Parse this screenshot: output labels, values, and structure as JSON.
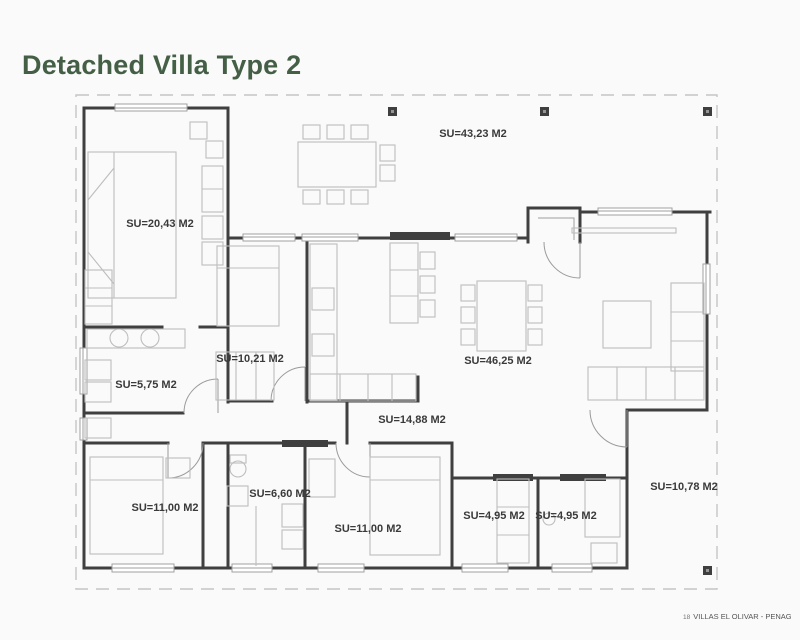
{
  "page": {
    "title": "Detached Villa Type 2"
  },
  "footer": {
    "prefix": "18",
    "text": "VILLAS EL OLIVAR - PENAGUILA"
  },
  "plan": {
    "rooms": [
      {
        "name": "front-terrace",
        "label": "SU=43,23 M2"
      },
      {
        "name": "bedroom-1",
        "label": "SU=20,43 M2"
      },
      {
        "name": "bedroom-2",
        "label": "SU=10,21 M2"
      },
      {
        "name": "bathroom-1",
        "label": "SU=5,75 M2"
      },
      {
        "name": "living-dining",
        "label": "SU=46,25 M2"
      },
      {
        "name": "kitchen-hall",
        "label": "SU=14,88 M2"
      },
      {
        "name": "bedroom-3",
        "label": "SU=11,00 M2"
      },
      {
        "name": "bathroom-2",
        "label": "SU=6,60 M2"
      },
      {
        "name": "bedroom-4",
        "label": "SU=11,00 M2"
      },
      {
        "name": "storage-1",
        "label": "SU=4,95 M2"
      },
      {
        "name": "storage-2",
        "label": "SU=4,95 M2"
      },
      {
        "name": "side-terrace",
        "label": "SU=10,78 M2"
      }
    ],
    "colors": {
      "wall": "#3f3f3f",
      "furniture": "#bdbdbd",
      "window": "#a0a0a0",
      "boundary": "#c5c5c5",
      "label": "#3a3a3a",
      "title": "#445f46",
      "background": "#fafafa"
    }
  }
}
